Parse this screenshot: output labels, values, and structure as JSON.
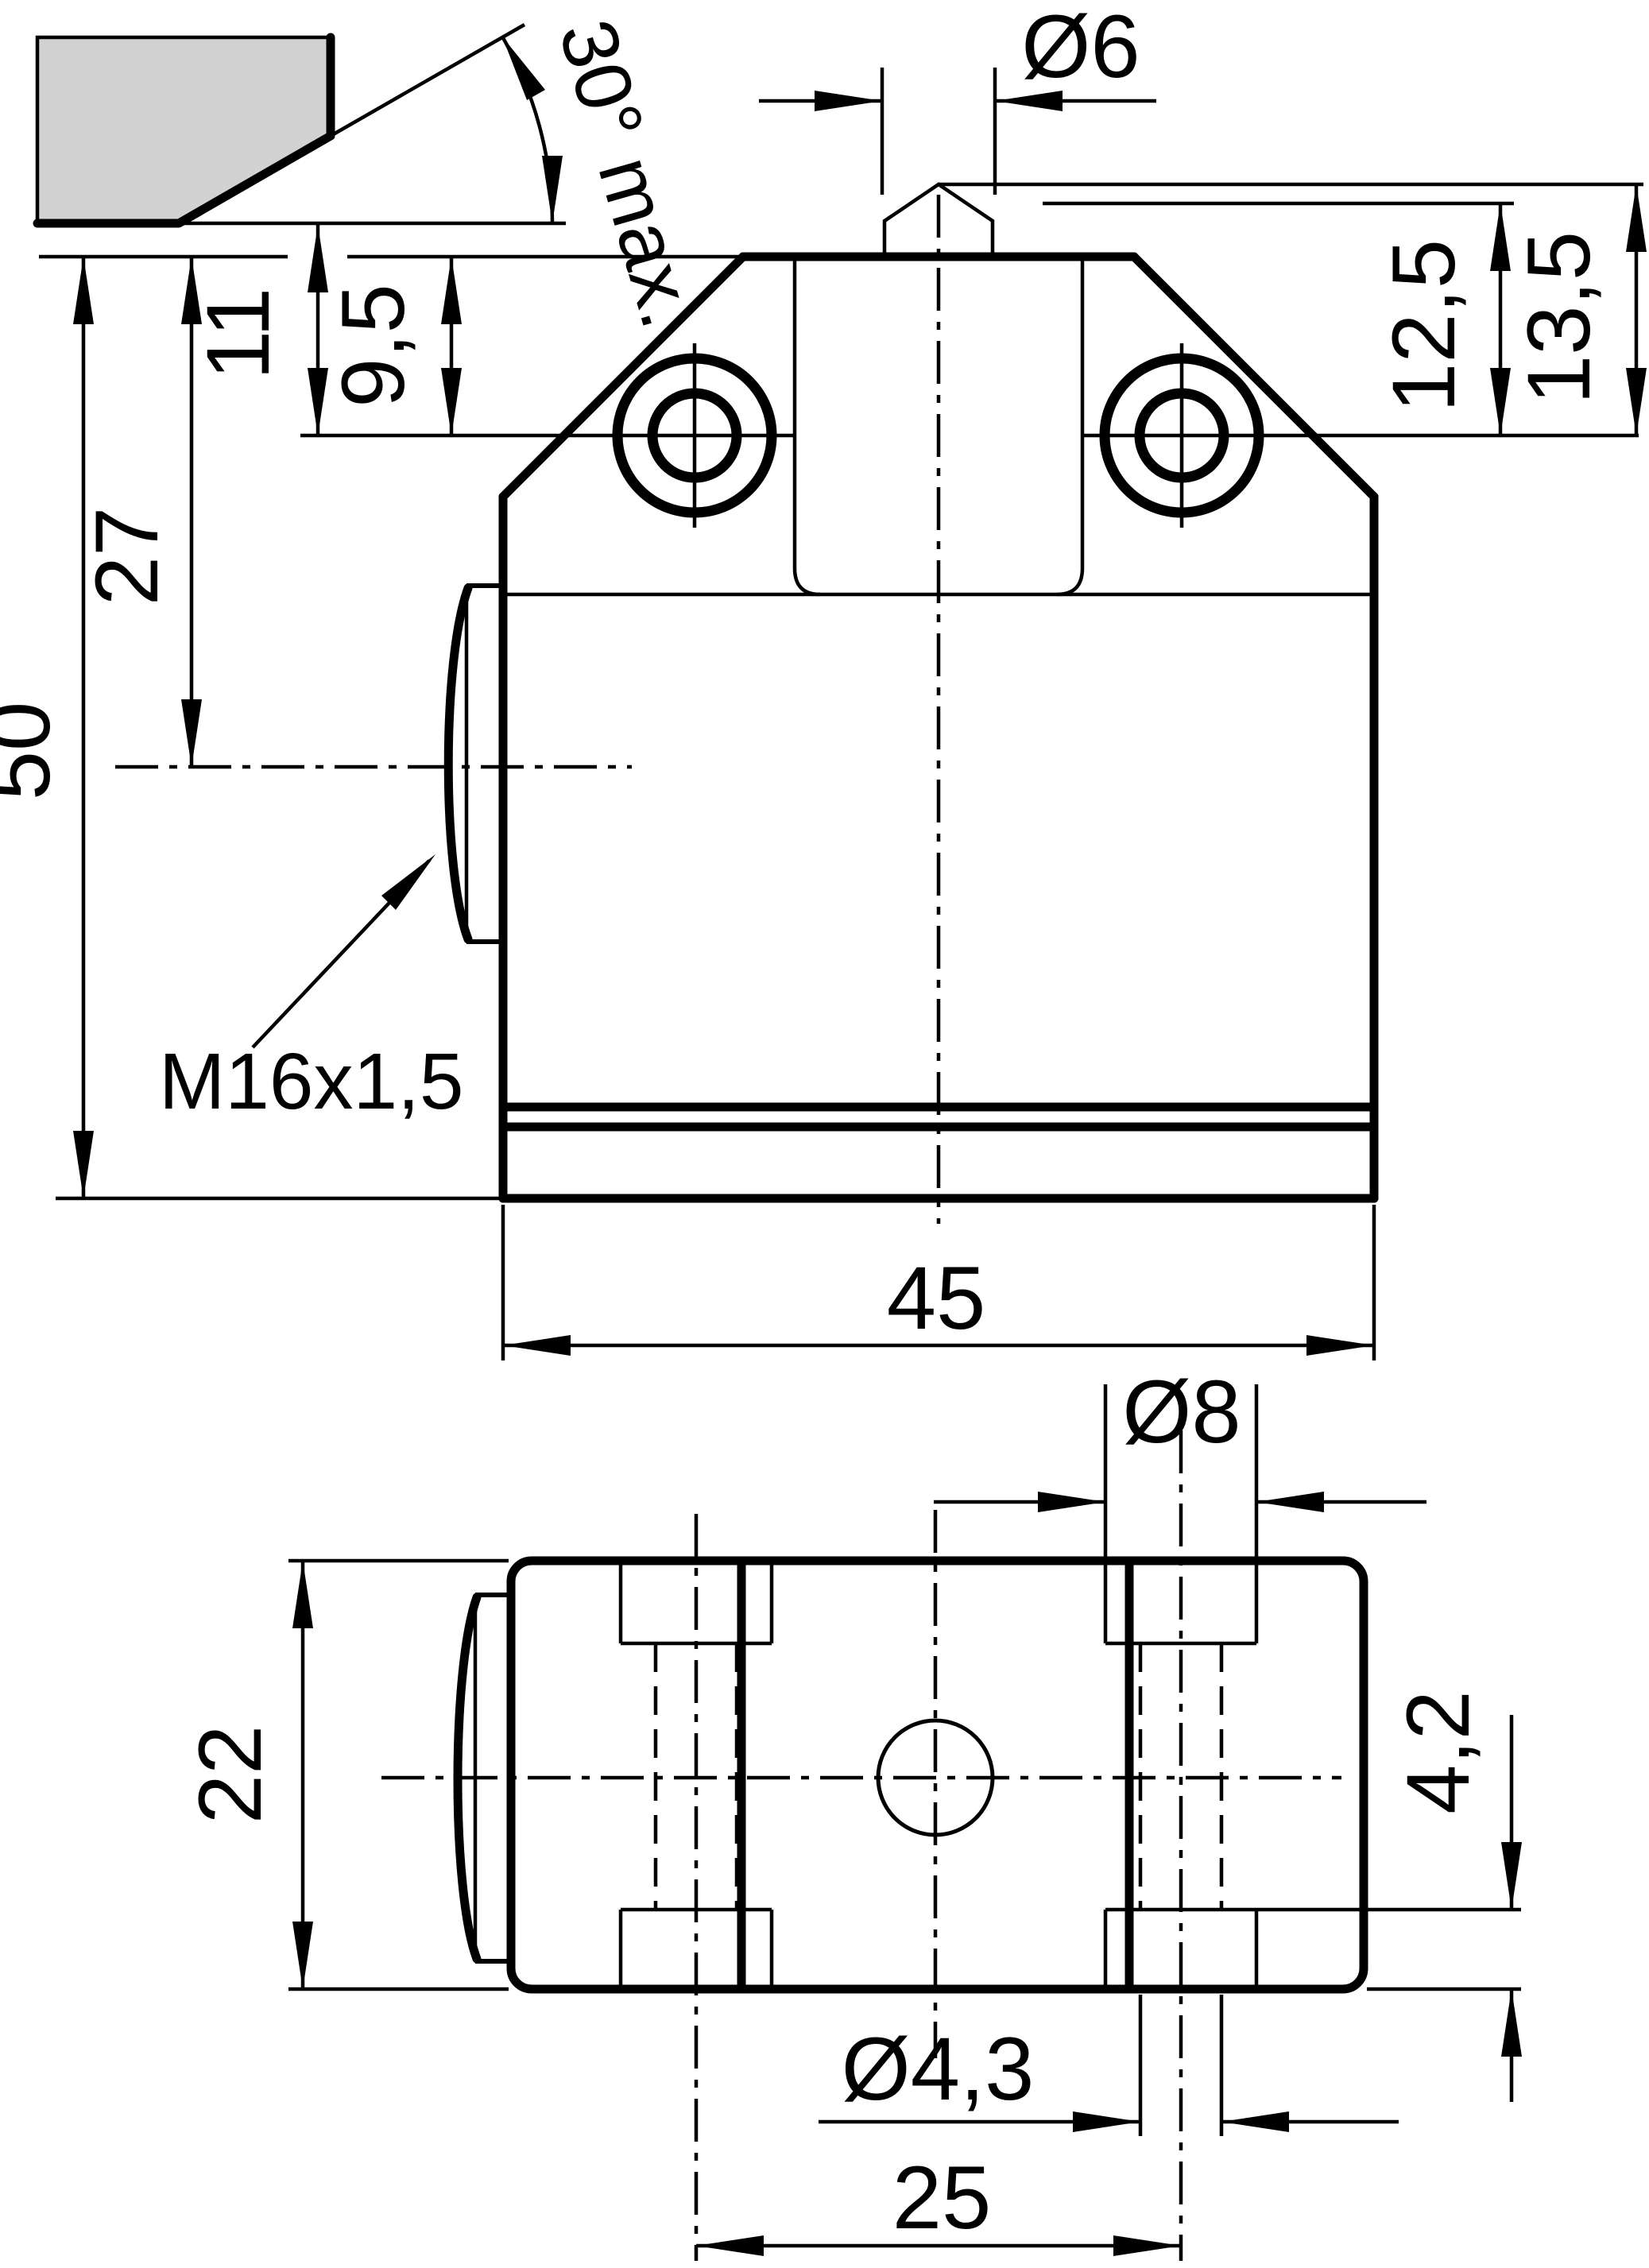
{
  "drawing": {
    "type": "technical-drawing",
    "subject": "limit-switch housing with plunger, front view and plan view, dimensioned in mm",
    "colors": {
      "line": "#000000",
      "cam_fill": "#d2d2d2",
      "background": "#ffffff"
    },
    "labels": {
      "angle": "30° max.",
      "plunger_dia": "Ø6",
      "dim_13_5": "13,5",
      "dim_12_5": "12,5",
      "dim_11": "11",
      "dim_9_5": "9,5",
      "dim_27": "27",
      "dim_50": "50",
      "dim_45": "45",
      "thread": "M16x1,5",
      "dim_22": "22",
      "counterbore_dia": "Ø8",
      "dim_4_2": "4,2",
      "hole_dia": "Ø4,3",
      "dim_25": "25"
    }
  }
}
